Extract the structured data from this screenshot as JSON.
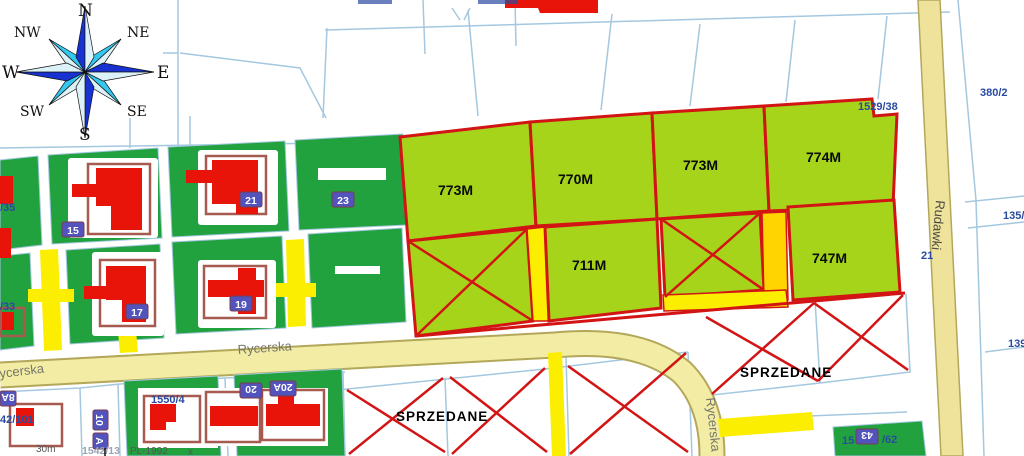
{
  "compass": {
    "n": "N",
    "ne": "NE",
    "e": "E",
    "se": "SE",
    "s": "S",
    "sw": "SW",
    "w": "W",
    "nw": "NW"
  },
  "streets": {
    "rycerska_center": "Rycerska",
    "rycerska_left": "ycerska",
    "rycerska_vertical": "Rycerska",
    "rudawki": "Rudawki"
  },
  "plots": {
    "row1": [
      {
        "area": "773M"
      },
      {
        "area": "770M"
      },
      {
        "area": "773M"
      },
      {
        "area": "774M"
      }
    ],
    "row2": [
      {
        "area": "711M"
      },
      {
        "area": "747M"
      }
    ]
  },
  "sold": {
    "left": "SPRZEDANE",
    "right": "SPRZEDANE"
  },
  "parcels": {
    "n1529_38": "1529/38",
    "n380_2": "380/2",
    "n135": "135/",
    "n21": "21",
    "n139": "139",
    "n1550_4": "1550/4",
    "n42_101": "42/101",
    "n35": "/35",
    "n33": "/33",
    "n1542_13": "1542/13",
    "n43_prefix": "15",
    "n43_suffix": "/62"
  },
  "house_numbers": {
    "h15": "15",
    "h17": "17",
    "h19": "19",
    "h21": "21",
    "h23": "23",
    "h8a": "8A",
    "h10": "10",
    "h10a": "A",
    "h20": "20",
    "h20a": "20A",
    "h43": "43"
  },
  "footer": {
    "scale": "30m",
    "crs": "PL-1992",
    "xmark": "x"
  },
  "colors": {
    "dark_green": "#22A23F",
    "light_green": "#A5D41A",
    "sale_border": "#D21414",
    "road_fill": "#F2ECA4",
    "driveway_yellow": "#FCEE00",
    "parcel_line": "#A4C8E0",
    "label_navy": "#2A4AA0",
    "house_red": "#E91409",
    "plate_blue": "#5353BE"
  }
}
